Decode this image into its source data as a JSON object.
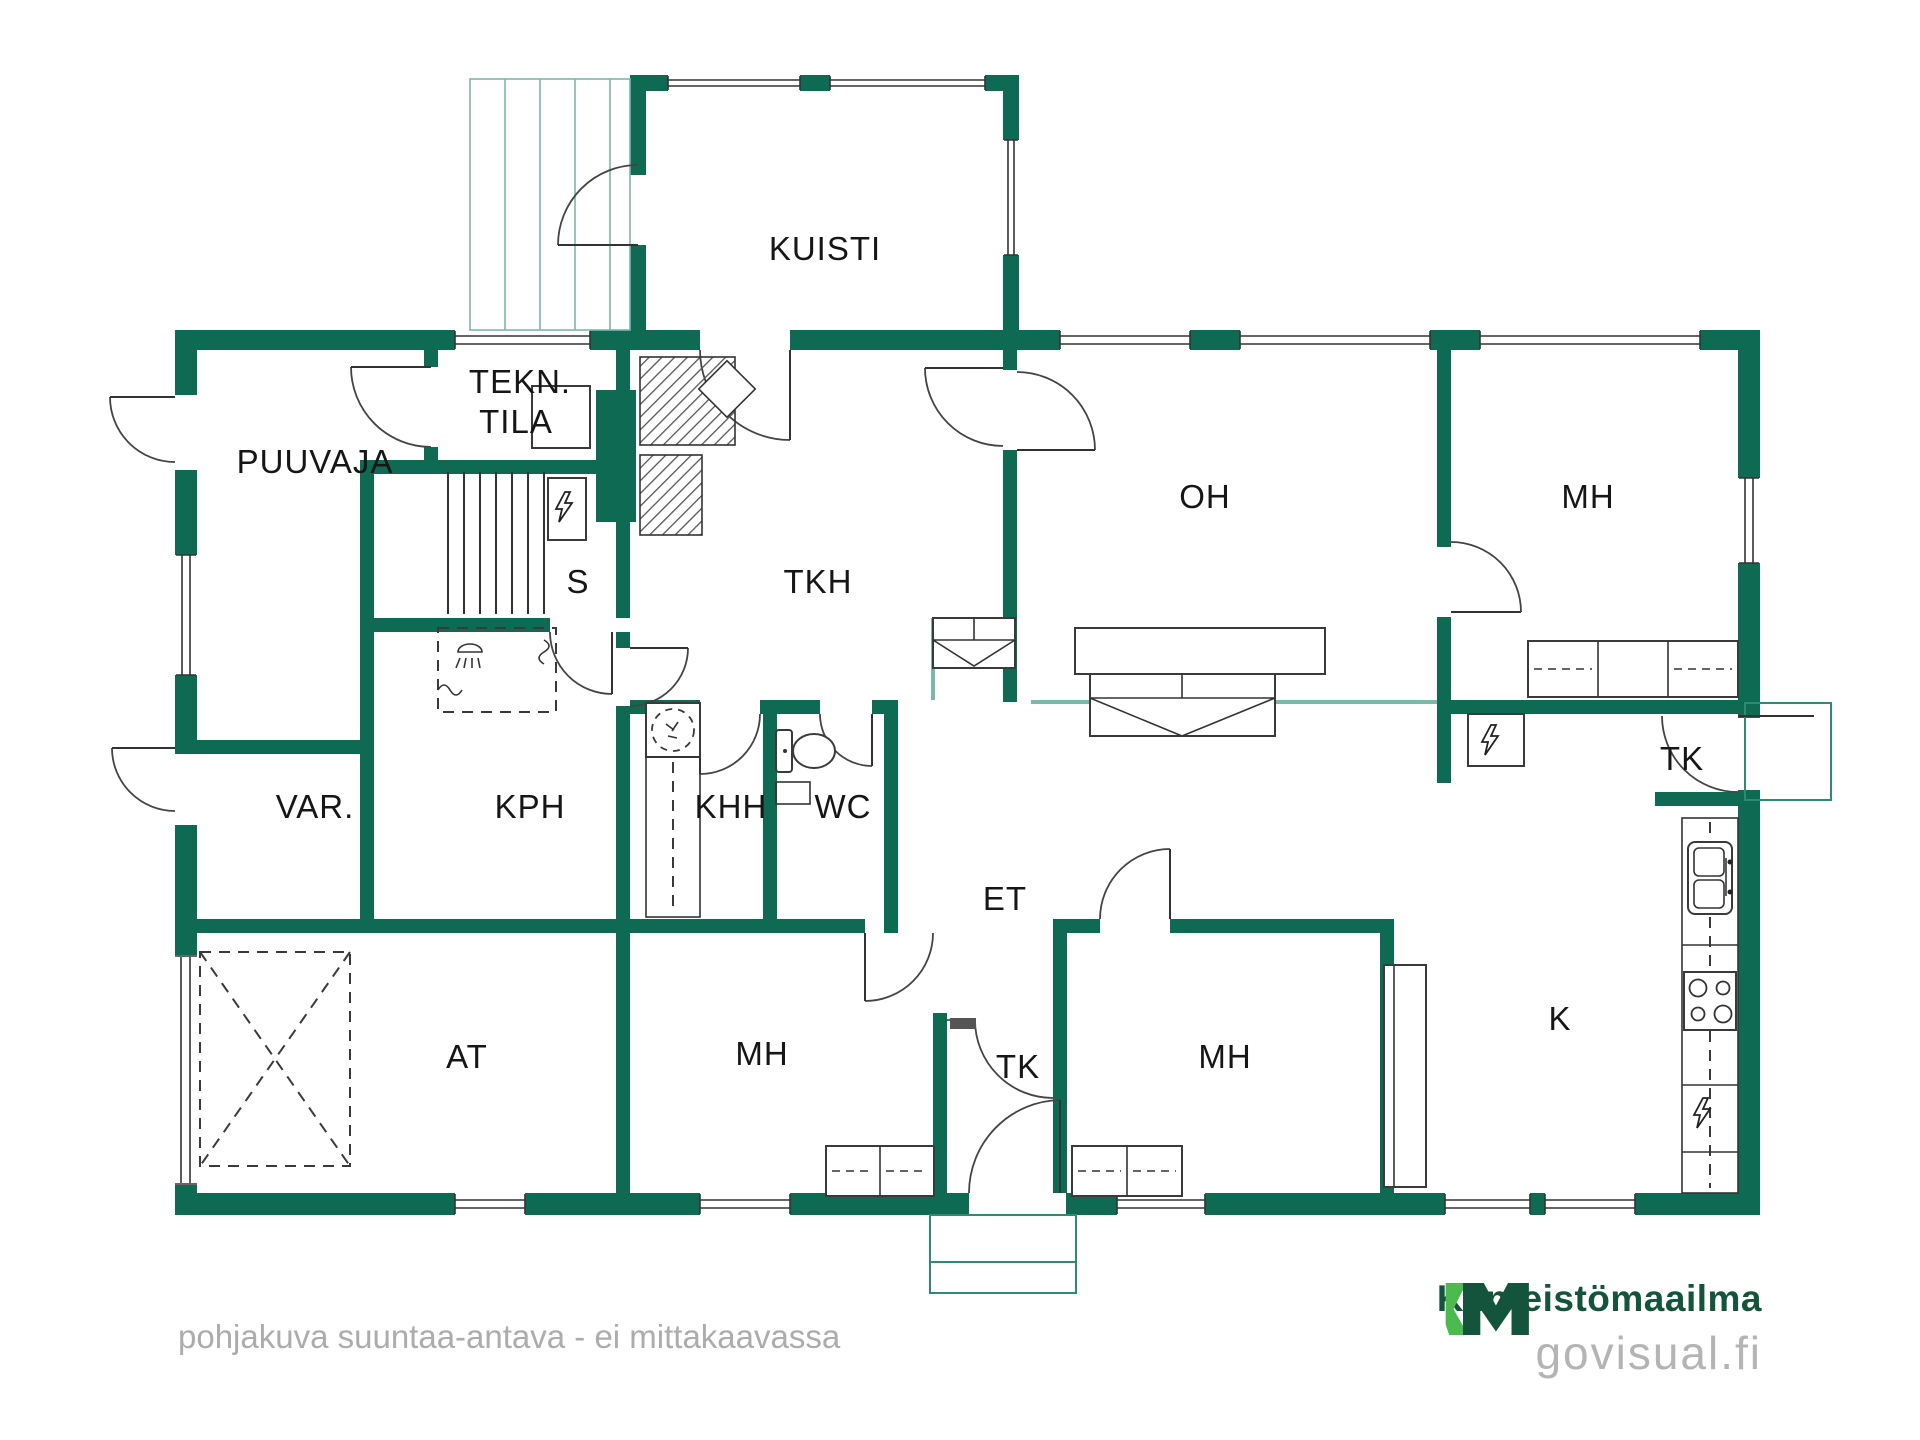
{
  "plan": {
    "type": "floor-plan",
    "rooms": {
      "kuisti": {
        "label": "KUISTI"
      },
      "tekn_tila": {
        "line1": "TEKN.",
        "line2": "TILA"
      },
      "puuvaja": {
        "label": "PUUVAJA"
      },
      "oh": {
        "label": "OH"
      },
      "mh_top_right": {
        "label": "MH"
      },
      "sauna": {
        "label": "S"
      },
      "tkh": {
        "label": "TKH"
      },
      "var": {
        "label": "VAR."
      },
      "kph": {
        "label": "KPH"
      },
      "khh": {
        "label": "KHH"
      },
      "wc": {
        "label": "WC"
      },
      "et": {
        "label": "ET"
      },
      "tk_entry": {
        "label": "TK"
      },
      "tk_closet": {
        "label": "TK"
      },
      "mh_bottom_right": {
        "label": "MH"
      },
      "mh_bottom_left": {
        "label": "MH"
      },
      "at": {
        "label": "AT"
      },
      "k": {
        "label": "K"
      }
    },
    "icons": {
      "sauna_heater": "lightning-bolt",
      "electrical_panel": "lightning-bolt",
      "kitchen_appliance": "lightning-bolt",
      "shower": "shower-head",
      "toilet": "toilet",
      "washing_machine": "washing-machine-dashed-circle",
      "stove": "stove-4-burner",
      "sink": "double-basin-sink",
      "fireplace": "hatched-masonry",
      "car_place": "dashed-x-box"
    },
    "colors": {
      "wall": "#0e6a52",
      "half_wall": "#7ab9a9",
      "porch_outline": "#2e8b72",
      "label_text": "#161616"
    }
  },
  "footer": {
    "disclaimer": "pohjakuva suuntaa-antava - ei mittakaavassa"
  },
  "branding": {
    "logo_mark": "KM",
    "company": "Kiinteistömaailma",
    "website": "govisual.fi",
    "colors": {
      "dark_green": "#14543c",
      "light_green": "#4cbb4f",
      "muted_gray": "#b4b4b4"
    }
  }
}
